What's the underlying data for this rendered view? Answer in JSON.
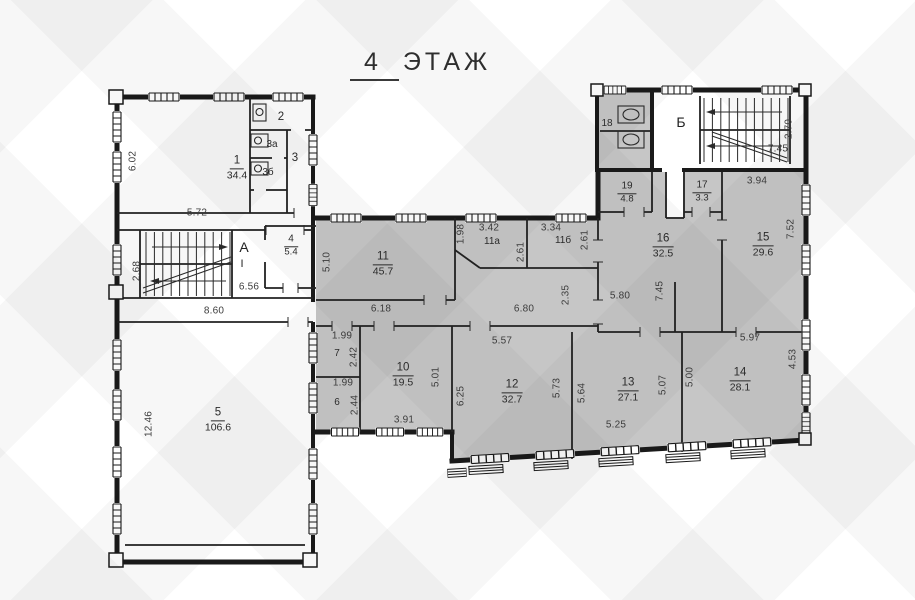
{
  "title": {
    "number": "4",
    "word": "ЭТАЖ"
  },
  "rooms": [
    {
      "number": "1",
      "area": "34.4"
    },
    {
      "number": "2",
      "area": ""
    },
    {
      "number": "3а",
      "area": ""
    },
    {
      "number": "3б",
      "area": ""
    },
    {
      "number": "3",
      "area": ""
    },
    {
      "number": "4",
      "area": "5.4"
    },
    {
      "number": "5",
      "area": "106.6"
    },
    {
      "number": "6",
      "area": ""
    },
    {
      "number": "7",
      "area": ""
    },
    {
      "number": "10",
      "area": "19.5"
    },
    {
      "number": "11",
      "area": "45.7"
    },
    {
      "number": "11а",
      "area": ""
    },
    {
      "number": "11б",
      "area": ""
    },
    {
      "number": "12",
      "area": "32.7"
    },
    {
      "number": "13",
      "area": "27.1"
    },
    {
      "number": "14",
      "area": "28.1"
    },
    {
      "number": "15",
      "area": "29.6"
    },
    {
      "number": "16",
      "area": "32.5"
    },
    {
      "number": "17",
      "area": "3.3"
    },
    {
      "number": "18",
      "area": ""
    },
    {
      "number": "19",
      "area": "4.8"
    }
  ],
  "stairs": [
    {
      "label": "А",
      "flight_mark": "I"
    },
    {
      "label": "Б"
    }
  ],
  "dims": [
    "6.02",
    "5.72",
    "2.68",
    "6.56",
    "8.60",
    "12.46",
    "5.10",
    "6.18",
    "1.99",
    "2.42",
    "1.99",
    "2.44",
    "3.91",
    "5.01",
    "3.42",
    "1.98",
    "2.61",
    "3.34",
    "2.61",
    "6.80",
    "2.35",
    "5.57",
    "6.25",
    "5.73",
    "5.64",
    "5.25",
    "5.07",
    "5.00",
    "5.80",
    "7.45",
    "3.94",
    "7.52",
    "5.97",
    "4.53",
    "2.70",
    "7.45"
  ],
  "colors": {
    "room_fill": "#c6c6c6",
    "wall": "#1a1a1a"
  }
}
